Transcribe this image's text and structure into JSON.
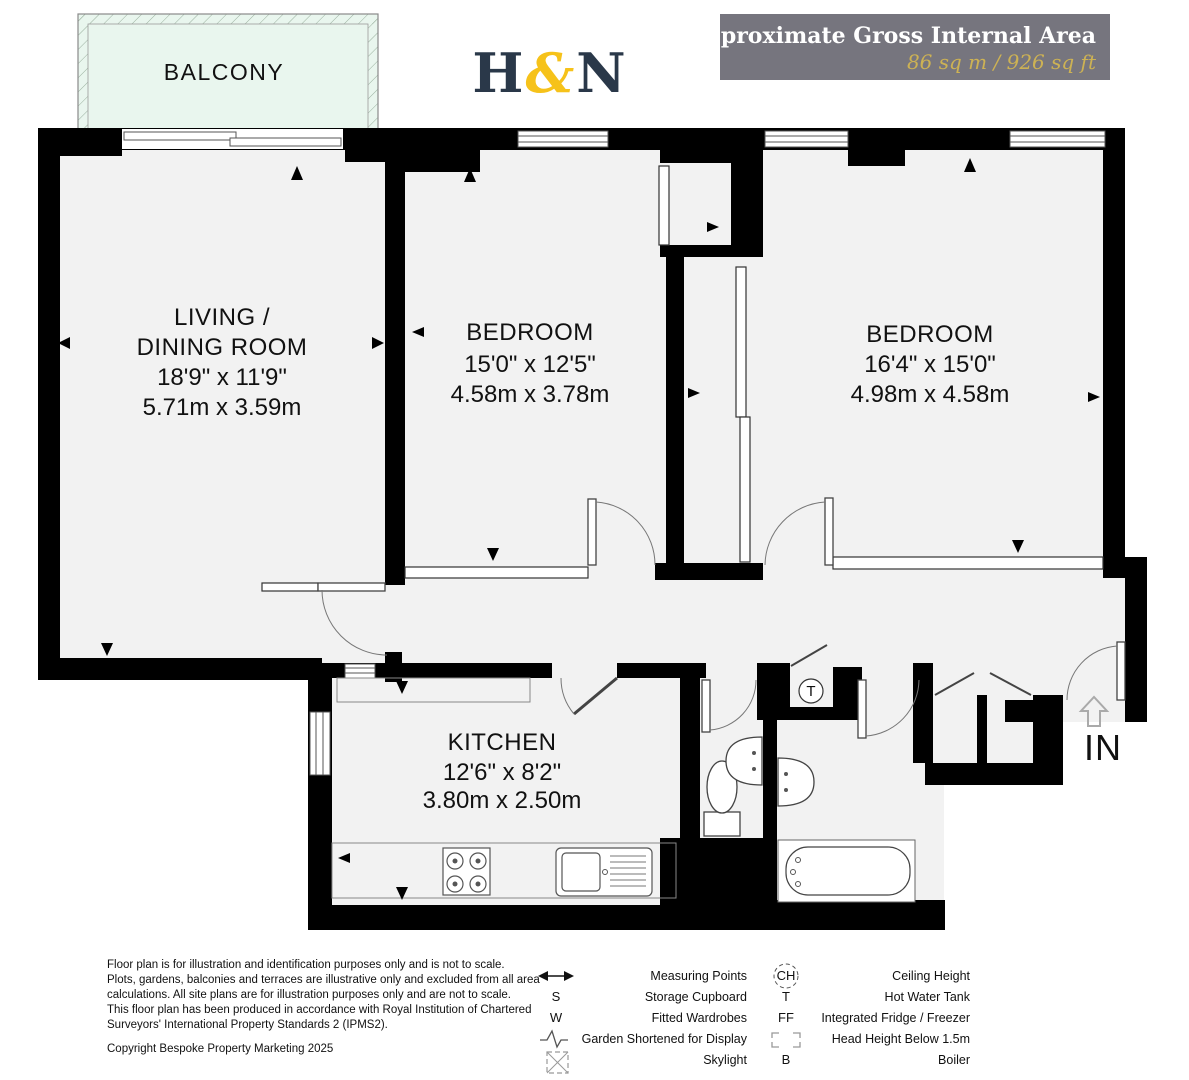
{
  "header": {
    "logo": {
      "part1": "H",
      "amp": "&",
      "part2": "N"
    },
    "area_box": {
      "title": "Approximate Gross Internal Area",
      "value": "86 sq m / 926 sq ft"
    }
  },
  "plan": {
    "balcony": "BALCONY",
    "entrance": "IN",
    "tank": "T",
    "rooms": {
      "living": {
        "line1": "LIVING /",
        "line2": "DINING ROOM",
        "imperial": "18'9\" x 11'9\"",
        "metric": "5.71m x 3.59m"
      },
      "bedroom1": {
        "name": "BEDROOM",
        "imperial": "15'0\" x 12'5\"",
        "metric": "4.58m x 3.78m"
      },
      "bedroom2": {
        "name": "BEDROOM",
        "imperial": "16'4\" x 15'0\"",
        "metric": "4.98m x 4.58m"
      },
      "kitchen": {
        "name": "KITCHEN",
        "imperial": "12'6\" x 8'2\"",
        "metric": "3.80m x 2.50m"
      }
    }
  },
  "footer": {
    "disclaimer": [
      "Floor plan is for illustration and identification purposes only and is not to scale.",
      "Plots, gardens, balconies and terraces are illustrative only and excluded from all area",
      "calculations.  All site plans are for illustration purposes only and are not to scale.",
      "This floor plan has been produced in accordance with Royal Institution of Chartered",
      "Surveyors' International Property Standards 2 (IPMS2)."
    ],
    "copyright": "Copyright Bespoke Property Marketing 2025",
    "legend_left": [
      {
        "symbol": "",
        "label": "Measuring Points"
      },
      {
        "symbol": "S",
        "label": "Storage Cupboard"
      },
      {
        "symbol": "W",
        "label": "Fitted Wardrobes"
      },
      {
        "symbol": "",
        "label": "Garden Shortened for Display"
      },
      {
        "symbol": "",
        "label": "Skylight"
      }
    ],
    "legend_right": [
      {
        "symbol": "CH",
        "label": "Ceiling Height"
      },
      {
        "symbol": "T",
        "label": "Hot Water Tank"
      },
      {
        "symbol": "FF",
        "label": "Integrated Fridge / Freezer"
      },
      {
        "symbol": "",
        "label": "Head Height Below 1.5m"
      },
      {
        "symbol": "B",
        "label": "Boiler"
      }
    ]
  },
  "colors": {
    "wall": "#000000",
    "floor": "#f2f2f2",
    "balcony_fill": "#e9f6ee",
    "box_gray": "#76757e",
    "accent_gold": "#cdb254",
    "logo_navy": "#2a3849",
    "logo_gold": "#f6c21a"
  }
}
